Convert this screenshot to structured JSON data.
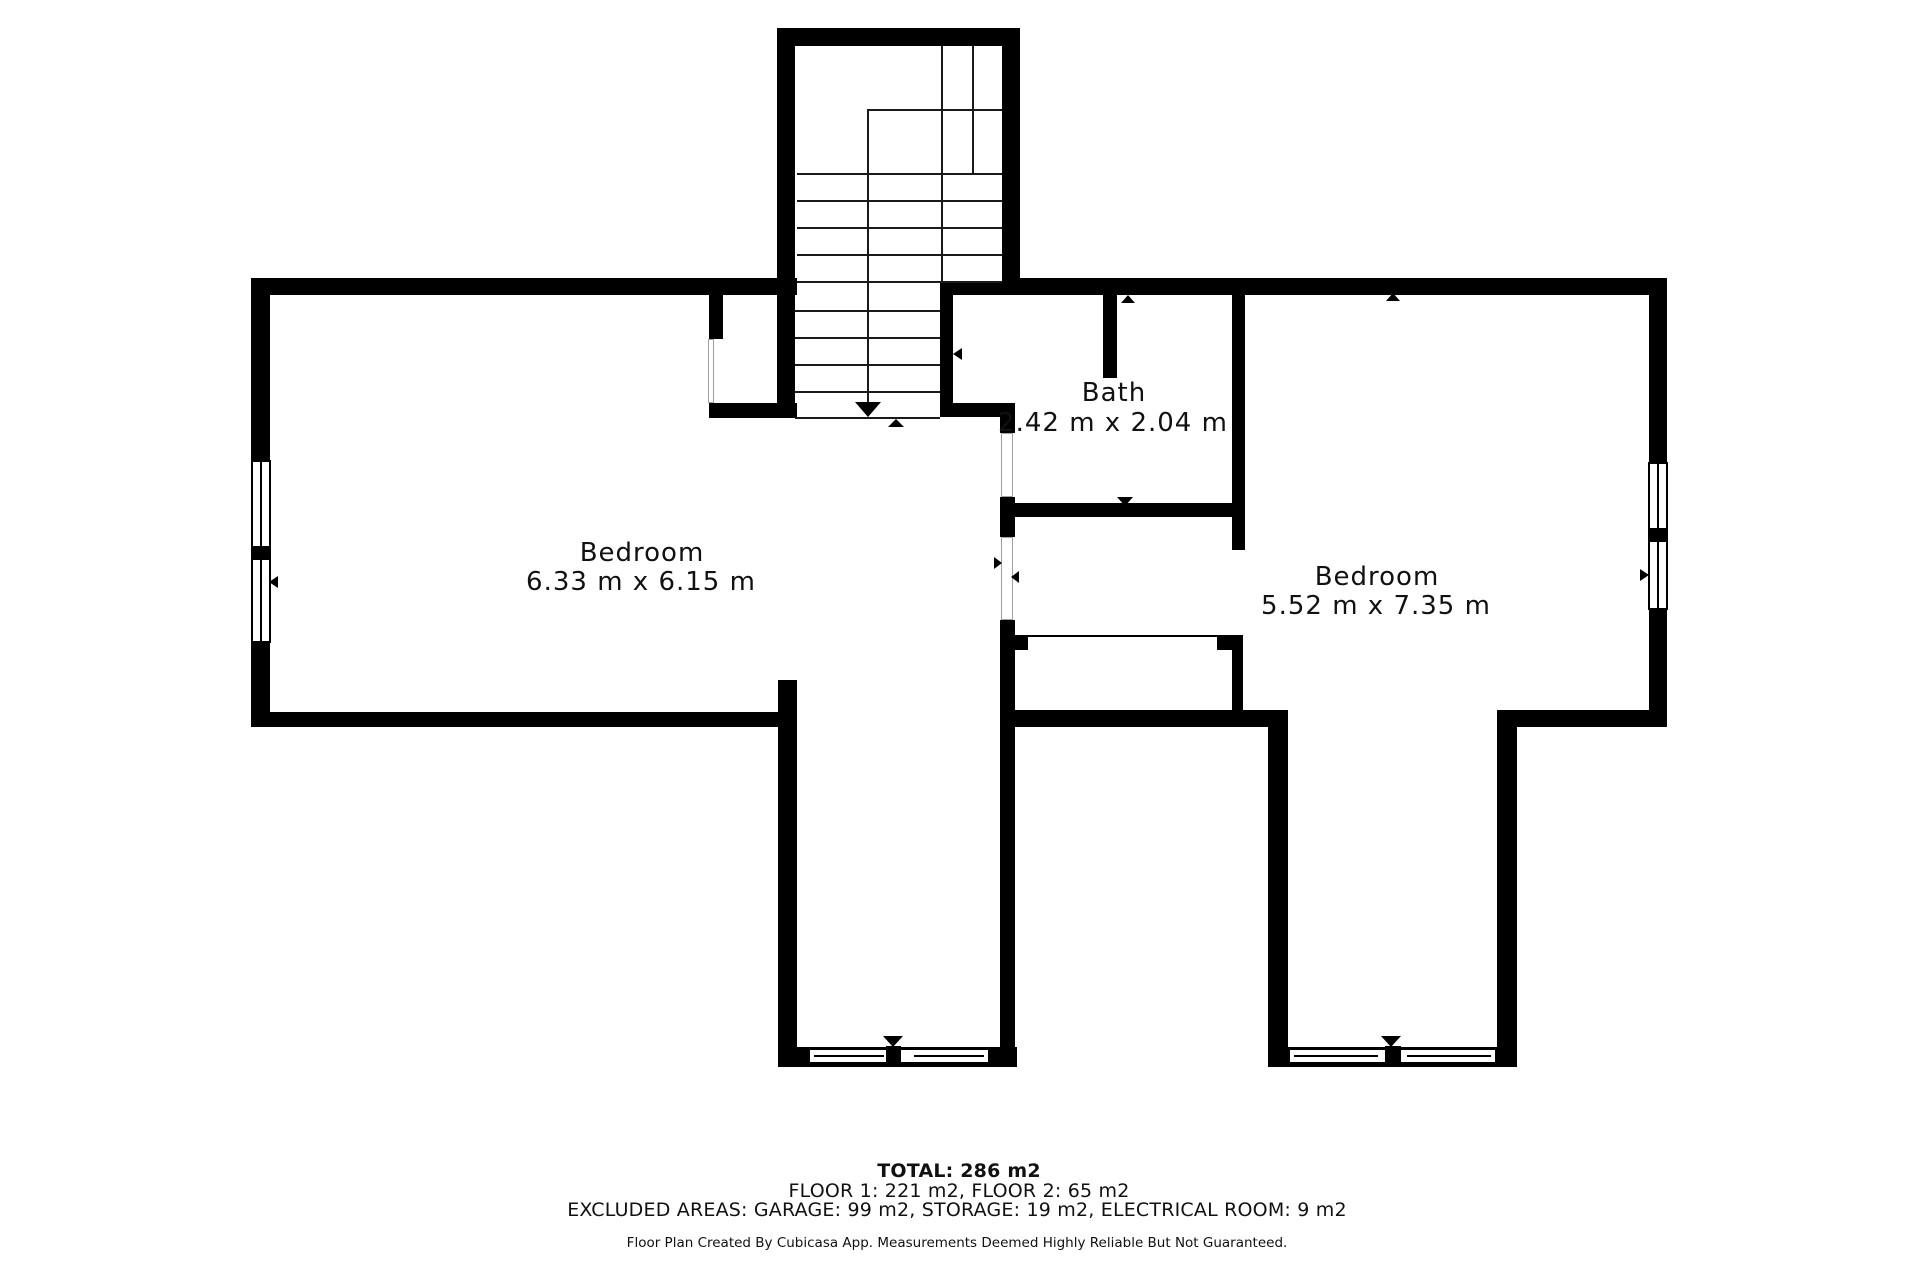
{
  "floor_plan": {
    "rooms": [
      {
        "id": "bedroom-left",
        "label": "Bedroom",
        "dimensions": "6.33 m x 6.15 m"
      },
      {
        "id": "bath",
        "label": "Bath",
        "dimensions": "2.42 m x 2.04 m"
      },
      {
        "id": "bedroom-right",
        "label": "Bedroom",
        "dimensions": "5.52 m x 7.35 m"
      }
    ],
    "footer": {
      "total": "TOTAL: 286 m2",
      "floors": "FLOOR 1: 221 m2, FLOOR 2: 65 m2",
      "excluded": "EXCLUDED AREAS: GARAGE: 99 m2, STORAGE: 19 m2, ELECTRICAL ROOM: 9 m2",
      "disclaimer": "Floor Plan Created By Cubicasa App. Measurements Deemed Highly Reliable But Not Guaranteed."
    },
    "colors": {
      "wall": "#000000",
      "background": "#ffffff",
      "text": "#111111",
      "door_leaf_outline": "#a0a0a0"
    }
  }
}
